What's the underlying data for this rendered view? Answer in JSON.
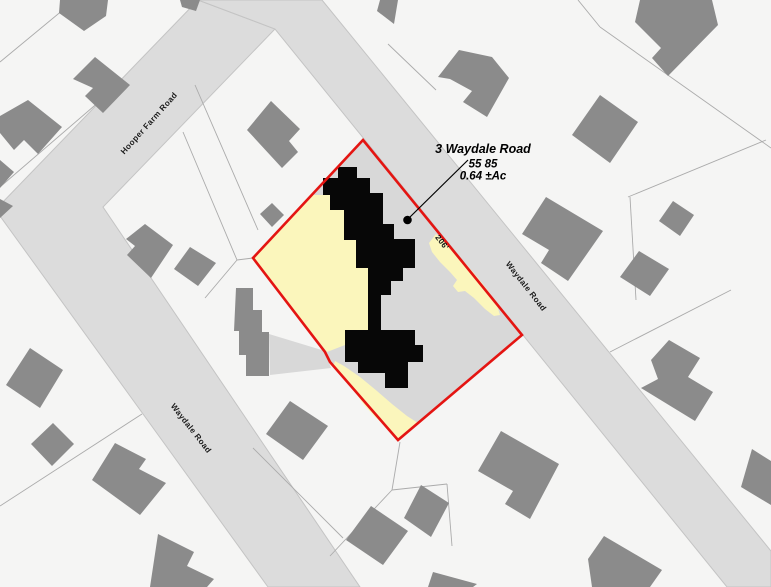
{
  "annotation": {
    "address": "3 Waydale Road",
    "parcel_id": "55 85",
    "area": "0.64 ±Ac"
  },
  "labels": {
    "road_labels": [
      {
        "text": "Hooper Farm Road",
        "x": 151,
        "y": 125,
        "rotate": -48
      },
      {
        "text": "Waydale Road",
        "x": 524,
        "y": 288,
        "rotate": 52
      },
      {
        "text": "Waydale Road",
        "x": 189,
        "y": 430,
        "rotate": 52
      }
    ],
    "dimension": {
      "text": "206'",
      "x": 440,
      "y": 244,
      "rotate": 52
    }
  },
  "colors": {
    "background": "#f5f5f4",
    "road_gray": "#dcdcdc",
    "road_edge": "#c4c4c4",
    "parcel_line_gray": "#ababab",
    "building_gray": "#8b8b8b",
    "building_black": "#070707",
    "subject_interior_gray": "#d8d8d8",
    "parcel_highlight_yellow": "#fbf6bc",
    "boundary_red": "#e41512"
  },
  "map": {
    "width": 771,
    "height": 587,
    "roads": [
      {
        "name": "road-hooper-farm-and-waydale-west",
        "points": [
          [
            198,
            0
          ],
          [
            275,
            29
          ],
          [
            103,
            207
          ],
          [
            360,
            587
          ],
          [
            268,
            587
          ],
          [
            0,
            216
          ],
          [
            0,
            205
          ]
        ]
      },
      {
        "name": "road-waydale-east",
        "points": [
          [
            198,
            0
          ],
          [
            322,
            0
          ],
          [
            771,
            551
          ],
          [
            771,
            587
          ],
          [
            727,
            587
          ],
          [
            275,
            29
          ]
        ]
      }
    ],
    "parcel_lines": [
      [
        75,
        0,
        0,
        62
      ],
      [
        115,
        88,
        0,
        187
      ],
      [
        195,
        85,
        258,
        230
      ],
      [
        183,
        132,
        237,
        260
      ],
      [
        237,
        260,
        253,
        258
      ],
      [
        237,
        260,
        205,
        298
      ],
      [
        388,
        44,
        436,
        90
      ],
      [
        578,
        0,
        600,
        27
      ],
      [
        600,
        27,
        771,
        148
      ],
      [
        628,
        197,
        766,
        140
      ],
      [
        630,
        197,
        636,
        300
      ],
      [
        610,
        352,
        731,
        290
      ],
      [
        0,
        506,
        142,
        414
      ],
      [
        253,
        448,
        343,
        538
      ],
      [
        400,
        442,
        392,
        490
      ],
      [
        392,
        490,
        447,
        484
      ],
      [
        392,
        490,
        330,
        556
      ],
      [
        447,
        484,
        452,
        546
      ]
    ],
    "buildings": [
      {
        "points": [
          [
            95,
            57
          ],
          [
            130,
            85
          ],
          [
            103,
            113
          ],
          [
            85,
            96
          ],
          [
            93,
            88
          ],
          [
            73,
            79
          ]
        ]
      },
      {
        "points": [
          [
            28,
            100
          ],
          [
            62,
            127
          ],
          [
            38,
            154
          ],
          [
            24,
            140
          ],
          [
            14,
            150
          ],
          [
            0,
            133
          ],
          [
            0,
            116
          ]
        ]
      },
      {
        "points": [
          [
            0,
            160
          ],
          [
            14,
            172
          ],
          [
            0,
            188
          ]
        ]
      },
      {
        "points": [
          [
            60,
            0
          ],
          [
            108,
            0
          ],
          [
            106,
            16
          ],
          [
            84,
            31
          ],
          [
            59,
            13
          ]
        ]
      },
      {
        "points": [
          [
            180,
            0
          ],
          [
            200,
            0
          ],
          [
            196,
            11
          ],
          [
            182,
            7
          ]
        ]
      },
      {
        "points": [
          [
            145,
            224
          ],
          [
            173,
            245
          ],
          [
            151,
            278
          ],
          [
            127,
            255
          ],
          [
            135,
            246
          ],
          [
            126,
            239
          ]
        ]
      },
      {
        "points": [
          [
            190,
            247
          ],
          [
            216,
            263
          ],
          [
            198,
            286
          ],
          [
            174,
            269
          ]
        ]
      },
      {
        "points": [
          [
            271,
            101
          ],
          [
            300,
            129
          ],
          [
            289,
            141
          ],
          [
            298,
            152
          ],
          [
            282,
            168
          ],
          [
            247,
            130
          ]
        ]
      },
      {
        "points": [
          [
            272,
            203
          ],
          [
            284,
            215
          ],
          [
            272,
            227
          ],
          [
            260,
            214
          ]
        ]
      },
      {
        "points": [
          [
            236,
            288
          ],
          [
            253,
            288
          ],
          [
            253,
            310
          ],
          [
            262,
            310
          ],
          [
            262,
            332
          ],
          [
            269,
            332
          ],
          [
            269,
            376
          ],
          [
            246,
            376
          ],
          [
            246,
            355
          ],
          [
            239,
            355
          ],
          [
            239,
            331
          ],
          [
            234,
            331
          ]
        ]
      },
      {
        "points": [
          [
            30,
            348
          ],
          [
            63,
            370
          ],
          [
            40,
            408
          ],
          [
            6,
            385
          ]
        ]
      },
      {
        "points": [
          [
            53,
            423
          ],
          [
            74,
            444
          ],
          [
            52,
            466
          ],
          [
            31,
            444
          ]
        ]
      },
      {
        "points": [
          [
            115,
            443
          ],
          [
            146,
            459
          ],
          [
            139,
            469
          ],
          [
            166,
            483
          ],
          [
            140,
            515
          ],
          [
            92,
            480
          ]
        ]
      },
      {
        "points": [
          [
            158,
            534
          ],
          [
            194,
            552
          ],
          [
            187,
            566
          ],
          [
            214,
            579
          ],
          [
            207,
            587
          ],
          [
            150,
            587
          ]
        ]
      },
      {
        "points": [
          [
            0,
            199
          ],
          [
            13,
            206
          ],
          [
            0,
            218
          ]
        ]
      },
      {
        "points": [
          [
            290,
            401
          ],
          [
            328,
            426
          ],
          [
            303,
            460
          ],
          [
            266,
            434
          ]
        ]
      },
      {
        "points": [
          [
            371,
            506
          ],
          [
            408,
            531
          ],
          [
            383,
            565
          ],
          [
            346,
            540
          ]
        ]
      },
      {
        "points": [
          [
            421,
            485
          ],
          [
            449,
            503
          ],
          [
            431,
            537
          ],
          [
            404,
            518
          ]
        ]
      },
      {
        "points": [
          [
            433,
            572
          ],
          [
            477,
            584
          ],
          [
            473,
            587
          ],
          [
            428,
            587
          ]
        ]
      },
      {
        "points": [
          [
            501,
            431
          ],
          [
            559,
            464
          ],
          [
            530,
            519
          ],
          [
            505,
            504
          ],
          [
            513,
            491
          ],
          [
            478,
            471
          ]
        ]
      },
      {
        "points": [
          [
            546,
            197
          ],
          [
            603,
            231
          ],
          [
            568,
            281
          ],
          [
            541,
            263
          ],
          [
            549,
            250
          ],
          [
            522,
            234
          ]
        ]
      },
      {
        "points": [
          [
            673,
            201
          ],
          [
            694,
            215
          ],
          [
            680,
            236
          ],
          [
            659,
            221
          ]
        ]
      },
      {
        "points": [
          [
            639,
            251
          ],
          [
            669,
            269
          ],
          [
            650,
            296
          ],
          [
            620,
            277
          ]
        ]
      },
      {
        "points": [
          [
            669,
            340
          ],
          [
            700,
            358
          ],
          [
            688,
            377
          ],
          [
            713,
            392
          ],
          [
            695,
            421
          ],
          [
            641,
            388
          ],
          [
            658,
            379
          ],
          [
            651,
            360
          ]
        ]
      },
      {
        "points": [
          [
            752,
            449
          ],
          [
            771,
            461
          ],
          [
            771,
            505
          ],
          [
            741,
            487
          ]
        ]
      },
      {
        "points": [
          [
            604,
            536
          ],
          [
            662,
            570
          ],
          [
            650,
            587
          ],
          [
            592,
            587
          ],
          [
            588,
            559
          ]
        ]
      },
      {
        "points": [
          [
            640,
            0
          ],
          [
            712,
            0
          ],
          [
            718,
            25
          ],
          [
            668,
            76
          ],
          [
            652,
            58
          ],
          [
            661,
            48
          ],
          [
            635,
            22
          ]
        ]
      },
      {
        "points": [
          [
            600,
            95
          ],
          [
            638,
            122
          ],
          [
            610,
            163
          ],
          [
            572,
            135
          ]
        ]
      },
      {
        "points": [
          [
            438,
            77
          ],
          [
            459,
            50
          ],
          [
            492,
            57
          ],
          [
            509,
            78
          ],
          [
            487,
            117
          ],
          [
            463,
            102
          ],
          [
            472,
            91
          ],
          [
            450,
            79
          ]
        ]
      },
      {
        "points": [
          [
            380,
            0
          ],
          [
            398,
            0
          ],
          [
            394,
            24
          ],
          [
            377,
            11
          ]
        ]
      }
    ],
    "subject": {
      "boundary": [
        [
          363,
          140
        ],
        [
          522,
          335
        ],
        [
          398,
          440
        ],
        [
          330,
          362
        ],
        [
          325,
          352
        ],
        [
          253,
          258
        ]
      ],
      "driveway_outside": [
        [
          269,
          334
        ],
        [
          325,
          351
        ],
        [
          331,
          368
        ],
        [
          270,
          375
        ]
      ],
      "yellow_regions": [
        [
          [
            313,
            195
          ],
          [
            330,
            195
          ],
          [
            330,
            210
          ],
          [
            344,
            210
          ],
          [
            344,
            240
          ],
          [
            356,
            240
          ],
          [
            356,
            268
          ],
          [
            368,
            268
          ],
          [
            368,
            330
          ],
          [
            345,
            330
          ],
          [
            345,
            345
          ],
          [
            327,
            352
          ],
          [
            253,
            258
          ]
        ],
        [
          [
            436,
            234
          ],
          [
            444,
            241
          ],
          [
            454,
            251
          ],
          [
            466,
            264
          ],
          [
            478,
            278
          ],
          [
            489,
            292
          ],
          [
            497,
            305
          ],
          [
            500,
            315
          ],
          [
            494,
            316
          ],
          [
            485,
            309
          ],
          [
            474,
            298
          ],
          [
            465,
            291
          ],
          [
            458,
            292
          ],
          [
            453,
            286
          ],
          [
            457,
            280
          ],
          [
            450,
            272
          ],
          [
            440,
            262
          ],
          [
            432,
            252
          ],
          [
            429,
            243
          ]
        ],
        [
          [
            333,
            367
          ],
          [
            345,
            377
          ],
          [
            355,
            392
          ],
          [
            364,
            405
          ],
          [
            374,
            416
          ],
          [
            386,
            427
          ],
          [
            398,
            439
          ],
          [
            411,
            429
          ],
          [
            418,
            423
          ],
          [
            407,
            416
          ],
          [
            392,
            404
          ],
          [
            377,
            391
          ],
          [
            360,
            377
          ],
          [
            344,
            366
          ],
          [
            335,
            361
          ]
        ]
      ],
      "building_black": [
        [
          338,
          167
        ],
        [
          357,
          167
        ],
        [
          357,
          178
        ],
        [
          370,
          178
        ],
        [
          370,
          193
        ],
        [
          383,
          193
        ],
        [
          383,
          209
        ],
        [
          383,
          224
        ],
        [
          394,
          224
        ],
        [
          394,
          239
        ],
        [
          415,
          239
        ],
        [
          415,
          268
        ],
        [
          403,
          268
        ],
        [
          403,
          281
        ],
        [
          391,
          281
        ],
        [
          391,
          295
        ],
        [
          381,
          295
        ],
        [
          381,
          330
        ],
        [
          415,
          330
        ],
        [
          415,
          345
        ],
        [
          423,
          345
        ],
        [
          423,
          362
        ],
        [
          408,
          362
        ],
        [
          408,
          388
        ],
        [
          385,
          388
        ],
        [
          385,
          373
        ],
        [
          358,
          373
        ],
        [
          358,
          362
        ],
        [
          345,
          362
        ],
        [
          345,
          330
        ],
        [
          368,
          330
        ],
        [
          368,
          268
        ],
        [
          356,
          268
        ],
        [
          356,
          240
        ],
        [
          344,
          240
        ],
        [
          344,
          210
        ],
        [
          330,
          210
        ],
        [
          330,
          195
        ],
        [
          323,
          195
        ],
        [
          323,
          178
        ],
        [
          338,
          178
        ]
      ]
    },
    "leader": {
      "x1": 468,
      "y1": 160,
      "x2": 410,
      "y2": 217,
      "dot": {
        "x": 407.5,
        "y": 220,
        "r": 4.3
      }
    }
  }
}
